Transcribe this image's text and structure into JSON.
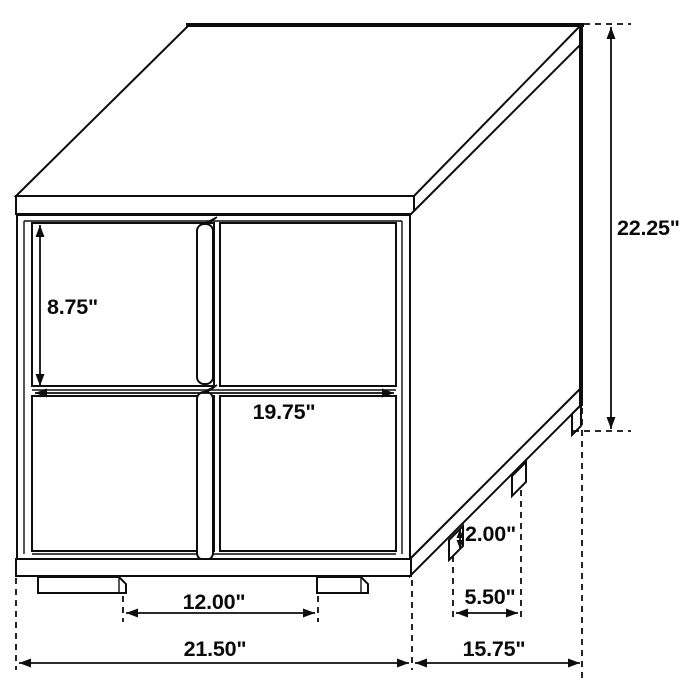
{
  "colors": {
    "line": "#0d0d0d",
    "background": "#ffffff"
  },
  "diagram": {
    "subject": "two-drawer nightstand line drawing with dimension callouts",
    "dimensions": {
      "drawer_height": "8.75\"",
      "overall_height": "22.25\"",
      "drawer_width": "19.75\"",
      "leg_height": "2.00\"",
      "side_leg_spacing": "5.50\"",
      "front_leg_spacing": "12.00\"",
      "overall_width": "21.50\"",
      "overall_depth": "15.75\""
    }
  }
}
